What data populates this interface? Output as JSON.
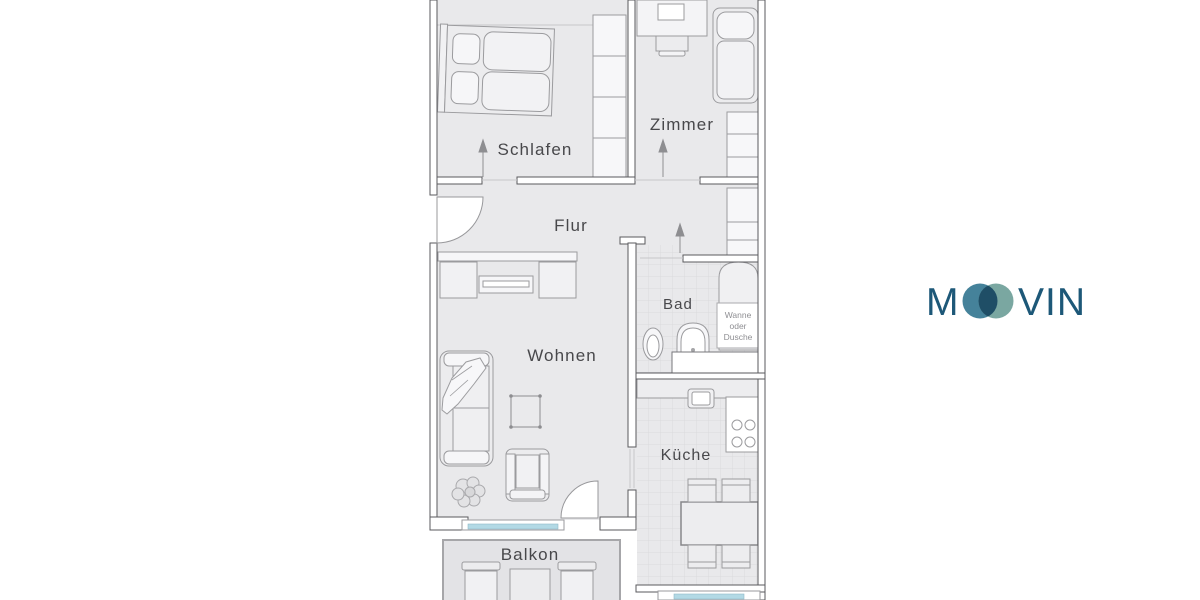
{
  "floorplan": {
    "rooms": {
      "schlafen": "Schlafen",
      "zimmer": "Zimmer",
      "flur": "Flur",
      "bad": "Bad",
      "wohnen": "Wohnen",
      "kueche": "Küche",
      "balkon": "Balkon"
    },
    "bath_note": {
      "line1": "Wanne",
      "line2": "oder",
      "line3": "Dusche"
    },
    "colors": {
      "floor": "#e9e9eb",
      "balcony_floor": "#e3e3e6",
      "tile_line": "#dbdbdd",
      "wall_line": "#5a5a5e",
      "furniture_line": "#9b9b9e",
      "label_text": "#48484b",
      "window_glass": "#b2d9e5"
    }
  },
  "logo": {
    "name": "MOOVIN",
    "text_left": "M",
    "text_right": "VIN",
    "color_text": "#1d5878",
    "color_circle_left": "#45829a",
    "color_circle_right": "#7aa7a1",
    "color_overlap": "#1f4e66"
  }
}
